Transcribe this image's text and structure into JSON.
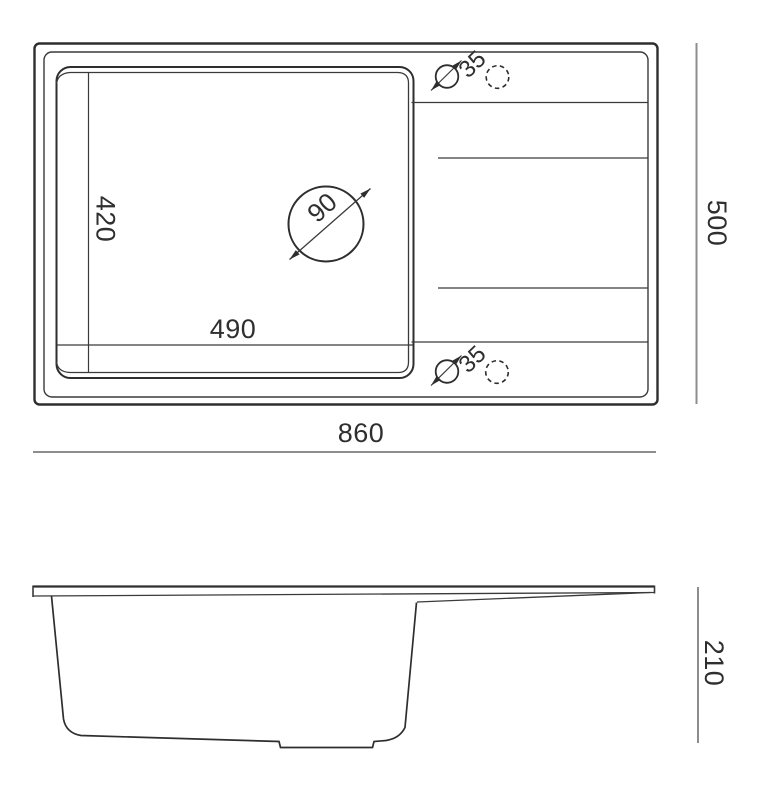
{
  "diagram": {
    "type": "sink-technical-drawing",
    "views": {
      "top_view": "plan",
      "side_view": "profile"
    },
    "dimensions": {
      "overall_length": "860",
      "overall_width": "500",
      "overall_height": "210",
      "basin_length": "490",
      "basin_width": "420",
      "drain_hole_diameter": "90",
      "tap_hole_top_diameter": "35",
      "tap_hole_bottom_diameter": "35"
    },
    "colors": {
      "line": "#2e2e2e",
      "dimension_line": "#8d8d8d",
      "background": "#ffffff"
    }
  }
}
